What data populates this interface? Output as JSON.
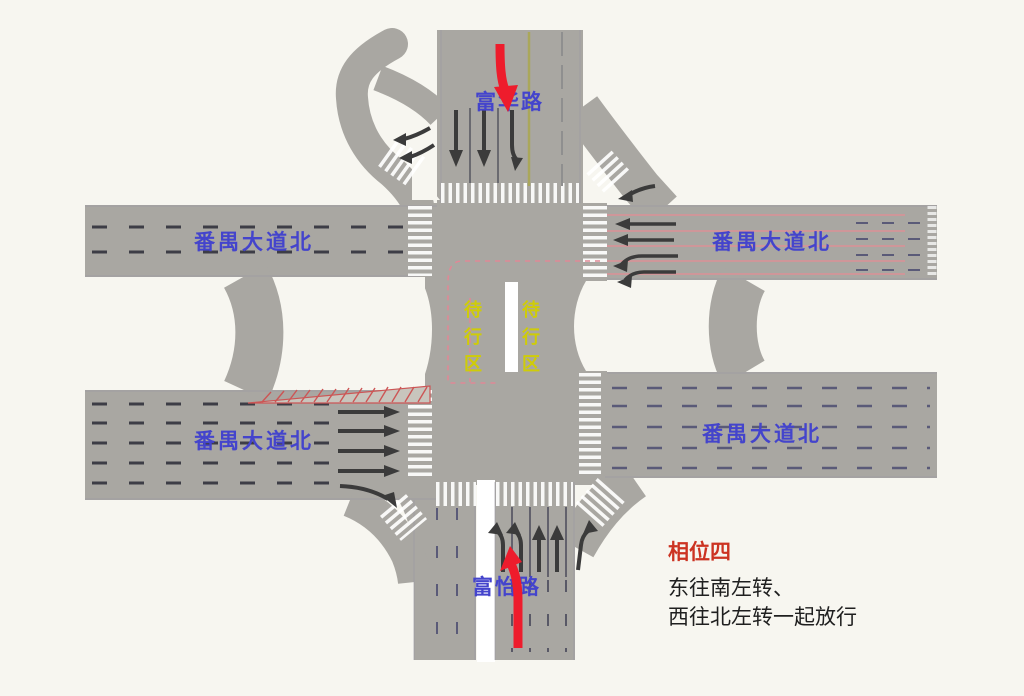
{
  "labels": {
    "north_road": "富华路",
    "south_road": "富怡路",
    "west_road_top": "番禺大道北",
    "east_road_top": "番禺大道北",
    "west_road_bottom": "番禺大道北",
    "east_road_bottom": "番禺大道北",
    "waiting_area_left": "待\n行\n区",
    "waiting_area_right": "待\n行\n区"
  },
  "phase_panel": {
    "title": "相位四",
    "line1": "东往南左转、",
    "line2": "西往北左转一起放行"
  },
  "colors": {
    "background": "#f7f6f0",
    "road": "#a9a7a2",
    "road_label": "#4444cc",
    "waiting_label": "#cfcc08",
    "phase_title": "#cc3322",
    "phase_text": "#1f1f1f",
    "release_arrow": "#ee1c2c",
    "lane_arrow": "#3b3b3b",
    "crosswalk": "#ffffff",
    "guide_pink": "#e08896",
    "hatch_red": "#cc5555",
    "dash_dark": "#3d3d46",
    "dash_blue": "#5a5a78",
    "pink_lane": "#dc9096",
    "center_line": "#aaa75a",
    "road_edge": "#9a98a3",
    "median_white": "#ffffff"
  }
}
